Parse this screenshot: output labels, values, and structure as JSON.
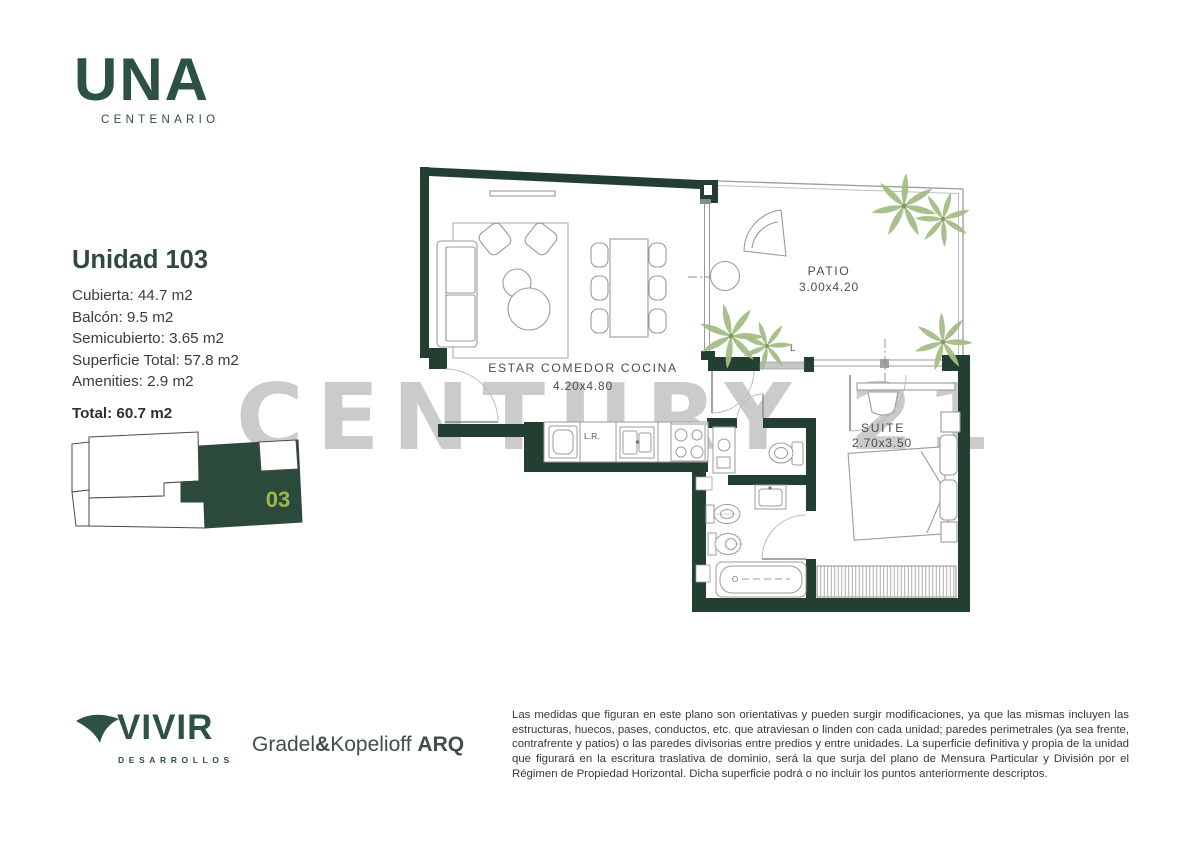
{
  "brand": {
    "name": "UNA",
    "subtitle": "CENTENARIO"
  },
  "unit": {
    "title": "Unidad 103",
    "details": [
      "Cubierta: 44.7 m2",
      "Balcón: 9.5 m2",
      "Semicubierto: 3.65 m2",
      "Superficie Total: 57.8 m2",
      "Amenities: 2.9 m2"
    ],
    "total": "Total: 60.7 m2"
  },
  "keyplan": {
    "unit_label": "03"
  },
  "plan": {
    "rooms": [
      {
        "name": "ESTAR COMEDOR COCINA",
        "dims": "4.20x4.80"
      },
      {
        "name": "PATIO",
        "dims": "3.00x4.20"
      },
      {
        "name": "SUITE",
        "dims": "2.70x3.50"
      }
    ],
    "labels": {
      "laundry": "L.R.",
      "corner": "L"
    }
  },
  "watermark": "CENTURY 21",
  "footer": {
    "developer": {
      "name": "VIVIR",
      "tagline": "DESARROLLOS"
    },
    "architect": {
      "name1": "Gradel",
      "amp": "&",
      "name2": "Kopelioff",
      "suffix": "ARQ"
    },
    "legal": "Las medidas que figuran en este plano son orientativas y pueden surgir modificaciones, ya que las mismas incluyen las estructuras, huecos, pases, conductos, etc. que atraviesan o linden con cada unidad; paredes perimetrales (ya sea frente, contrafrente y patios) o las paredes divisorias entre predios y entre unidades. La superficie definitiva y propia de la unidad que figurará en la escritura traslativa de dominio, será la que surja del plano de Mensura Particular y División por el Régimen de Propiedad Horizontal. Dicha superficie podrá o no incluir los puntos anteriormente descriptos."
  },
  "colors": {
    "wall_green": "#233f32",
    "brand_green": "#2d5143",
    "keyplan_green": "#2c4a3b",
    "unit_number_green": "#9bba4a",
    "watermark_gray": "#cbcbcb",
    "palm_green": "#a4bd85"
  }
}
